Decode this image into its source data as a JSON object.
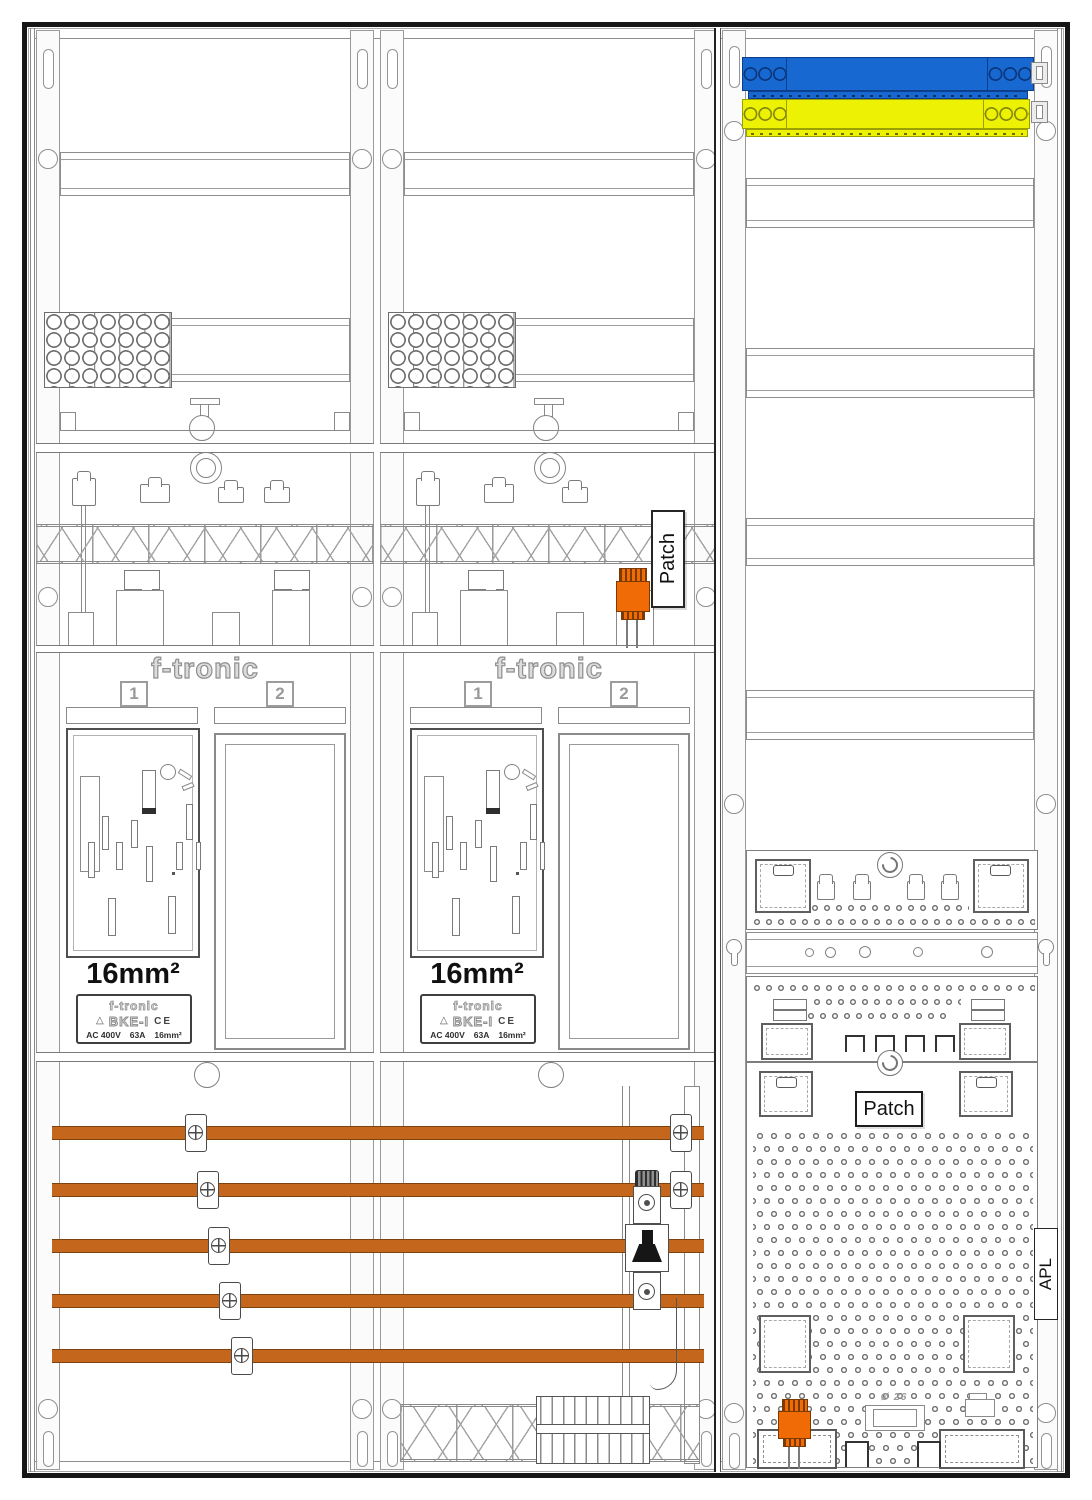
{
  "meter_fields": [
    {
      "brand": "f-tronic",
      "position_labels": [
        "1",
        "2"
      ],
      "cross_section": "16mm²",
      "type_plate": {
        "brand": "f-tronic",
        "model": "BKE-I",
        "ce_mark": "CE",
        "rating_voltage": "AC 400V",
        "rating_current": "63A",
        "rating_cross_section": "16mm²"
      }
    },
    {
      "brand": "f-tronic",
      "position_labels": [
        "1",
        "2"
      ],
      "cross_section": "16mm²",
      "type_plate": {
        "brand": "f-tronic",
        "model": "BKE-I",
        "ce_mark": "CE",
        "rating_voltage": "AC 400V",
        "rating_current": "63A",
        "rating_cross_section": "16mm²"
      }
    }
  ],
  "wiring_section": {
    "patch_duct_label": "Patch"
  },
  "media_section": {
    "patch_panel_label": "Patch",
    "apl_marking": "APL",
    "grommet_diameter": "Ø 26"
  },
  "icons": {
    "insulation_triangle": "△"
  },
  "busbar_system": {
    "bar_count": 5,
    "copper_color": "#c4661c"
  },
  "colors": {
    "connector_orange": "#f06b05",
    "busbar_blue": "#1868d2",
    "busbar_yellow": "#edf103"
  }
}
